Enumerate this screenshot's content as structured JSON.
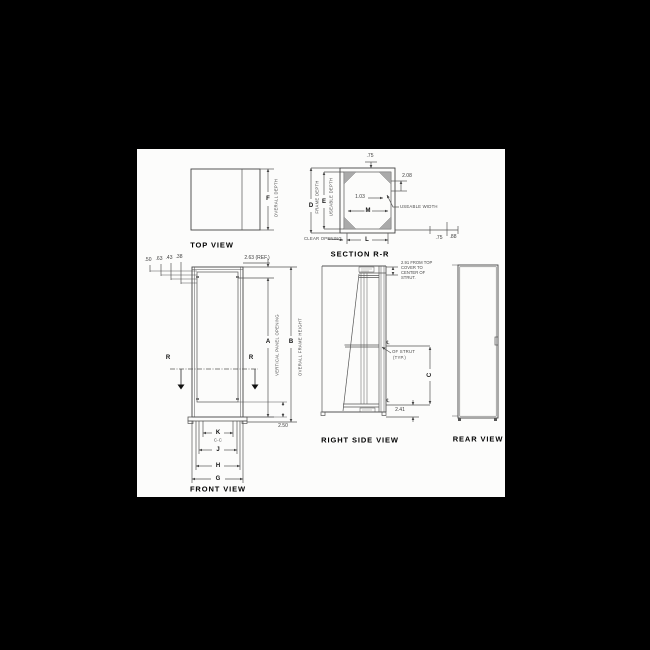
{
  "colors": {
    "background": "#000000",
    "paper": "#fcfcfb",
    "ink": "#555555"
  },
  "top_view": {
    "title": "TOP VIEW",
    "dim_f": "F",
    "dim_f_label": "OVERALL DEPTH"
  },
  "section_rr": {
    "title": "SECTION R-R",
    "val_top": ".75",
    "dim_d": "D",
    "dim_d_label": "FRAME DEPTH",
    "dim_e": "E",
    "dim_e_label": "USEABLE DEPTH",
    "val_208": "2.08",
    "val_103": "1.03",
    "dim_m": "M",
    "useable_width": "USEABLE WIDTH",
    "clear_opening": "CLEAR OPENING",
    "dim_l": "L",
    "val_75": ".75",
    "val_88": ".88"
  },
  "front_view": {
    "title": "FRONT VIEW",
    "small_dims": [
      ".50",
      ".63",
      ".43",
      ".38"
    ],
    "val_ref": "2.63 (REF.)",
    "section_letter": "R",
    "dim_a": "A",
    "dim_a_label": "VERTICAL PANEL OPENING",
    "dim_b": "B",
    "dim_b_label": "OVERALL FRAME HEIGHT",
    "val_250": "2.50",
    "dim_k": "K",
    "dim_k_sub": "C-C",
    "dim_j": "J",
    "dim_h": "H",
    "dim_g": "G"
  },
  "right_side_view": {
    "title": "RIGHT SIDE VIEW",
    "note_line1": "2.91 FROM TOP",
    "note_line2": "COVER TO",
    "note_line3": "CENTER OF",
    "note_line4": "STRUT.",
    "cl_symbol": "℄",
    "strut_label1": "OF STRUT",
    "strut_label2": "(TYP.)",
    "dim_c": "C",
    "val_241": "2.41"
  },
  "rear_view": {
    "title": "REAR VIEW"
  }
}
